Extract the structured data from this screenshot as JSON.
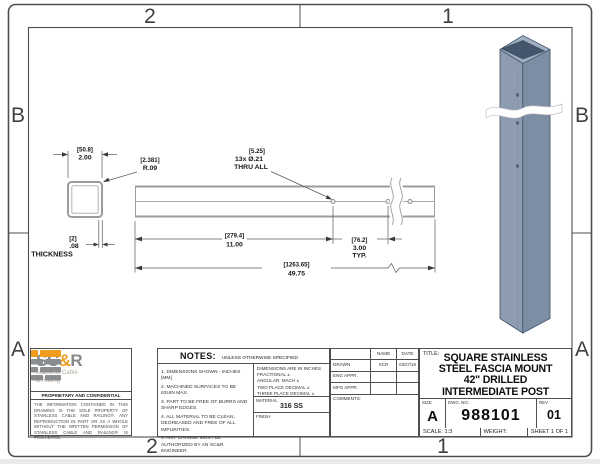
{
  "sheet": {
    "zone_cols": [
      "2",
      "1"
    ],
    "zone_rows": [
      "B",
      "A"
    ]
  },
  "drawing": {
    "section_view": {
      "width_mm": "[50.8]",
      "width_in": "2.00",
      "radius_mm": "[2.381]",
      "radius_in": "R.09",
      "thickness_mm": "[2]",
      "thickness_in": ".08",
      "thickness_label": "THICKNESS"
    },
    "side_view": {
      "holes_mm": "[5.25]",
      "holes_callout": "13x Ø.21",
      "holes_thru": "THRU ALL",
      "first_hole_mm": "[279.4]",
      "first_hole_in": "11.00",
      "spacing_mm": "[76.2]",
      "spacing_in": "3.00",
      "spacing_typ": "TYP.",
      "overall_mm": "[1263.65]",
      "overall_in": "49.75"
    }
  },
  "logo": {
    "name_sc": "SC",
    "name_amp": "&",
    "name_r": "R",
    "sub1": "Stainless Cable",
    "sub2": "& Railing",
    "proprietary_title": "PROPRIETARY AND CONFIDENTIAL",
    "proprietary_text": "THE INFORMATION CONTAINED IN THIS DRAWING IS THE SOLE PROPERTY OF STAINLESS CABLE AND RAILING®. ANY REPRODUCTION IN PART OR AS A WHOLE WITHOUT THE WRITTEN PERMISSION OF STAINLESS CABLE AND RAILING® IS PROHIBITED."
  },
  "notes": {
    "header": "NOTES:",
    "header_sub": "UNLESS OTHERWISE SPECIFIED",
    "items": [
      "1. DIMENSIONS SHOWN - INCHES [MM]",
      "2. MACHINED SURFACES TO BE 63UIN MAX.",
      "3. PART TO BE FREE OF BURRS AND SHARP EDGES.",
      "4. ALL MATERIAL TO BE CLEAN, DEGREASED AND FREE OF ALL IMPURITIES.",
      "5. ANY CHANGE MUST BE AUTHORIZED BY AN SC&R ENGINEER."
    ],
    "tolerances": [
      "DIMENSIONS ARE IN INCHES",
      "FRACTIONAL ±",
      "ANGULAR: MACH ±",
      "TWO PLACE DECIMAL ±",
      "THREE PLACE DECIMAL ±"
    ],
    "material_label": "MATERIAL",
    "material_value": "316 SS",
    "finish_label": "FINISH"
  },
  "approvals": {
    "name_header": "NAME",
    "date_header": "DATE",
    "rows": [
      {
        "label": "DRAWN",
        "name": "SCR",
        "date": "03/27/18"
      },
      {
        "label": "ENG APPR.",
        "name": "",
        "date": ""
      },
      {
        "label": "MFG APPR.",
        "name": "",
        "date": ""
      }
    ],
    "comments_label": "COMMENTS:"
  },
  "title_block": {
    "title_label": "TITLE:",
    "title_lines": [
      "SQUARE STAINLESS",
      "STEEL FASCIA MOUNT",
      "42\" DRILLED",
      "INTERMEDIATE POST"
    ],
    "size_label": "SIZE",
    "size_value": "A",
    "dwg_label": "DWG.  NO.",
    "dwg_value": "988101",
    "rev_label": "REV",
    "rev_value": "01",
    "scale_label": "SCALE: 1:3",
    "weight_label": "WEIGHT:",
    "sheet_label": "SHEET 1 OF 1"
  },
  "colors": {
    "logo_orange": "#F09C1E",
    "logo_gray": "#8A8D8F",
    "post_left_face": "#8D9CB1",
    "post_right_face": "#7D8DA3",
    "part_line": "#9C9C9C",
    "border_line": "#4F4F4F"
  }
}
